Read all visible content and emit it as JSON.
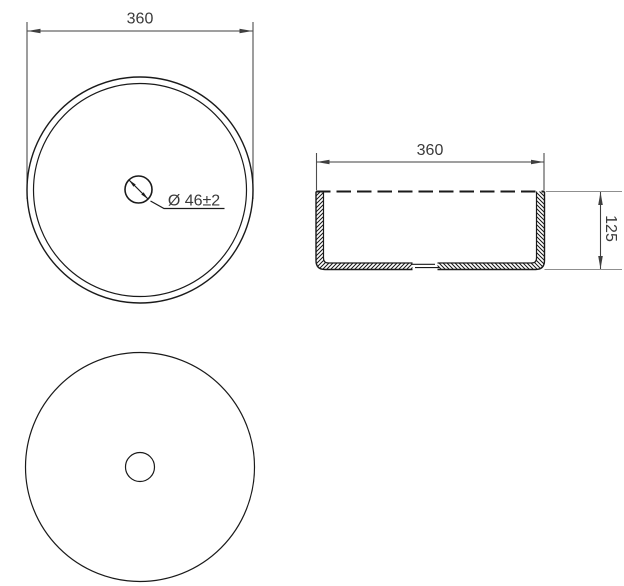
{
  "views": {
    "top": {
      "width_dim": "360",
      "drain_dim": "Ø 46±2"
    },
    "side": {
      "width_dim": "360",
      "height_dim": "125"
    },
    "bottom": {}
  },
  "colors": {
    "object_line": "#1a1a1a",
    "dimension_line": "#4d4d4d",
    "extension_line": "#8f8f8f",
    "text": "#3a3a3a",
    "background": "#ffffff"
  }
}
